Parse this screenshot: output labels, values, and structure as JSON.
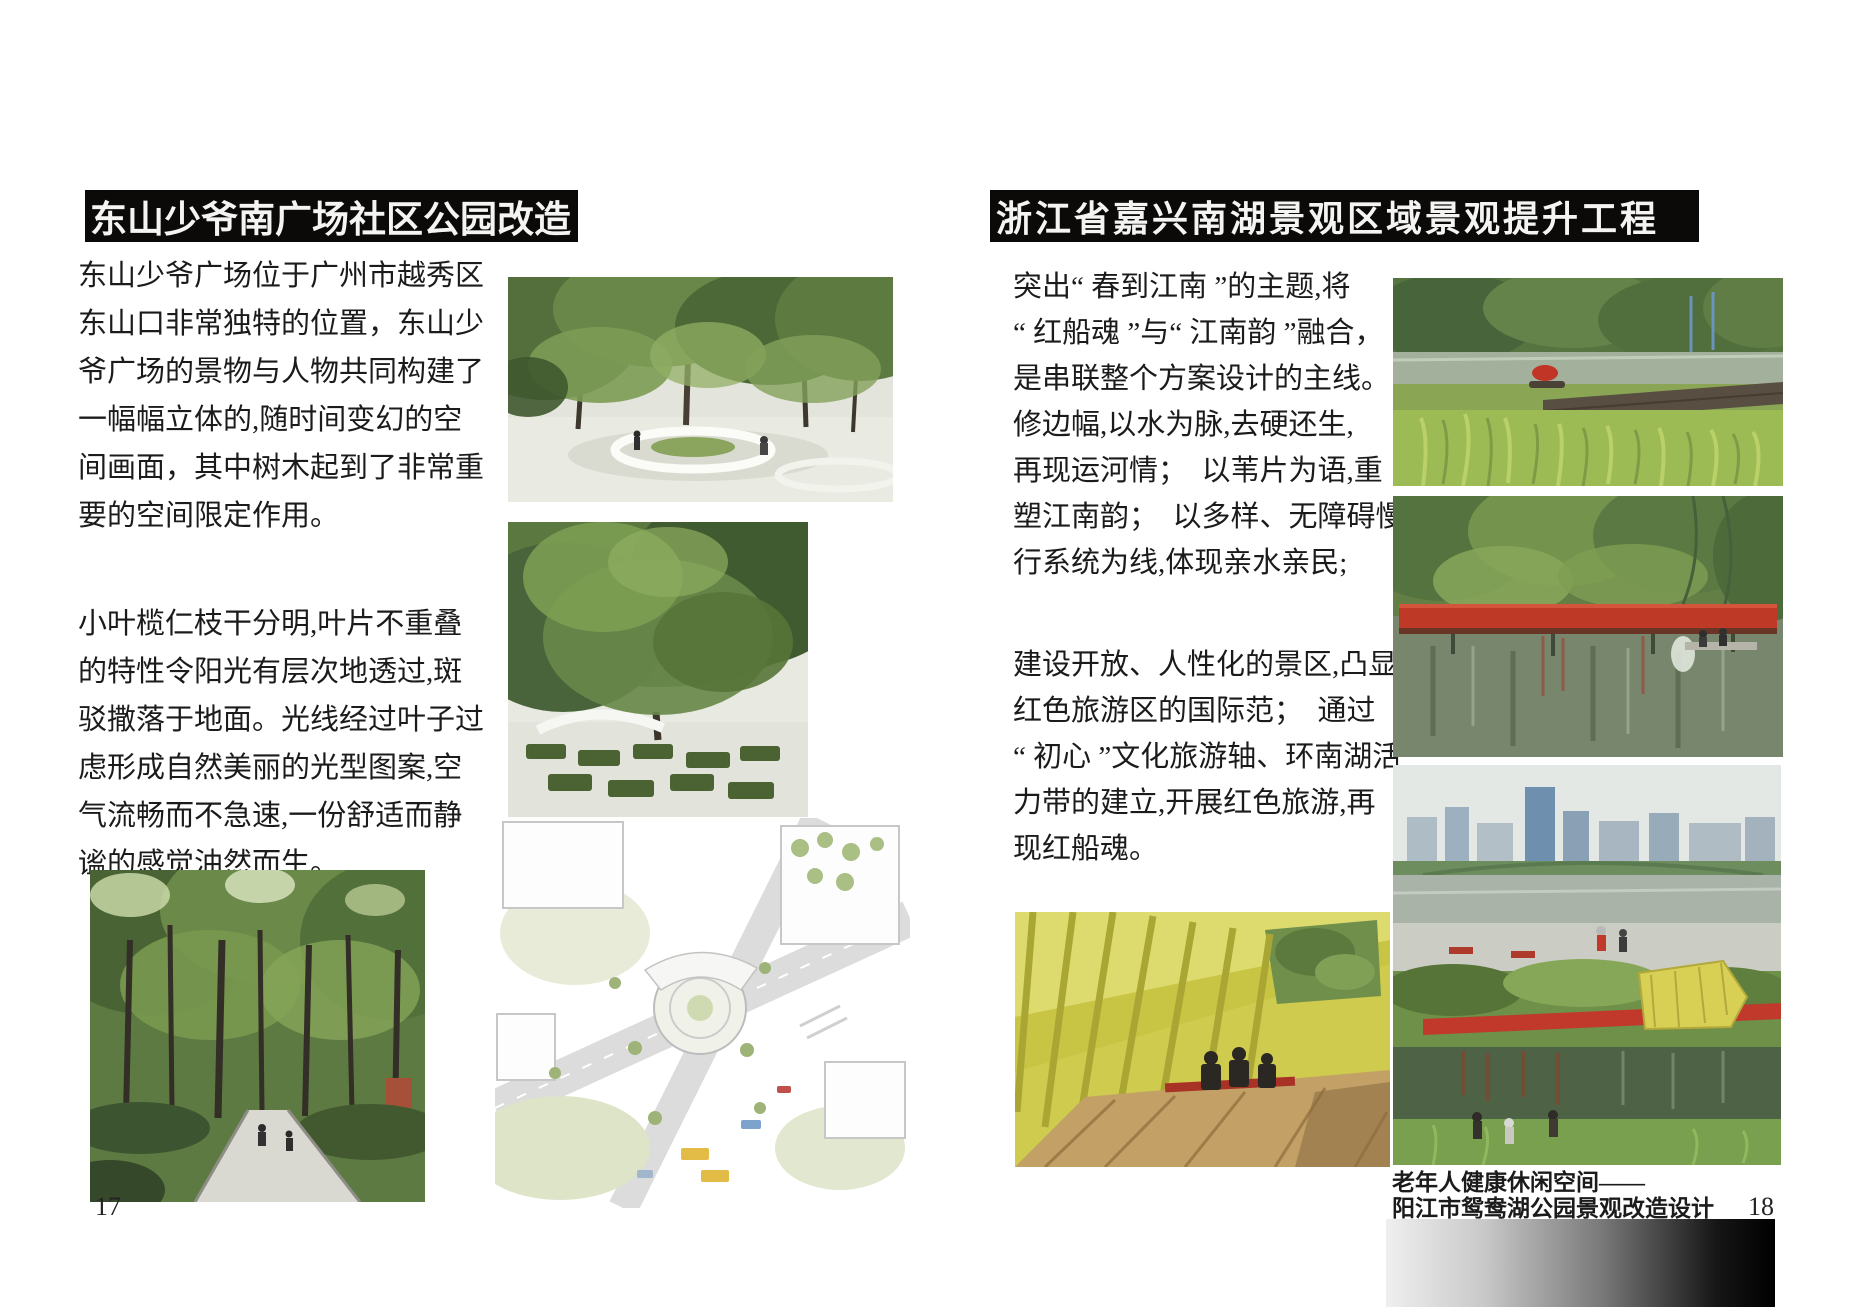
{
  "document": {
    "left_page": {
      "title": "东山少爷南广场社区公园改造",
      "paragraph_1": "东山少爷广场位于广州市越秀区\n东山口非常独特的位置，东山少\n爷广场的景物与人物共同构建了\n一幅幅立体的,随时间变幻的空\n间画面，其中树木起到了非常重\n要的空间限定作用。",
      "paragraph_2": "小叶榄仁枝干分明,叶片不重叠\n的特性令阳光有层次地透过,斑\n驳撒落于地面。光线经过叶子过\n虑形成自然美丽的光型图案,空\n气流畅而不急速,一份舒适而静\n谧的感觉油然而生。",
      "page_number": "17"
    },
    "right_page": {
      "title": "浙江省嘉兴南湖景观区域景观提升工程",
      "paragraph_1": "突出“ 春到江南 ”的主题,将\n“ 红船魂 ”与“ 江南韵 ”融合，\n是串联整个方案设计的主线。\n修边幅,以水为脉,去硬还生,\n再现运河情；  以苇片为语,重\n塑江南韵；  以多样、无障碍慢\n行系统为线,体现亲水亲民;",
      "paragraph_2": "建设开放、人性化的景区,凸显\n红色旅游区的国际范；  通过\n“ 初心 ”文化旅游轴、环南湖活\n力带的建立,开展红色旅游,再\n现红船魂。",
      "caption": "老年人健康休闲空间——\n阳江市鸳鸯湖公园景观改造设计",
      "page_number": "18"
    },
    "colors": {
      "title_bar_bg": "#0c0a09",
      "title_text": "#f4f4f2",
      "body_text": "#1b1b1b",
      "accent_red": "#c0392a",
      "bridge_red": "#bf3a26",
      "pavilion_yellow": "#d6d35a",
      "gradient_bar_start": "#efefef",
      "gradient_bar_end": "#000000"
    }
  }
}
